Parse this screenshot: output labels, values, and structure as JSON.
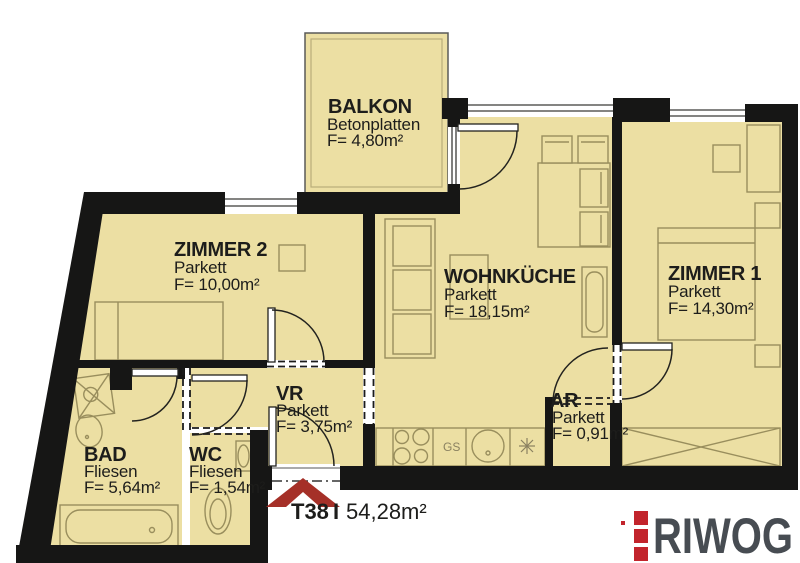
{
  "plan": {
    "unit": {
      "label": "T38",
      "separator": "I",
      "area": "54,28m²"
    },
    "rooms": [
      {
        "name": "BALKON",
        "floor": "Betonplatten",
        "area": "F= 4,80m²"
      },
      {
        "name": "ZIMMER 2",
        "floor": "Parkett",
        "area": "F= 10,00m²"
      },
      {
        "name": "WOHNKÜCHE",
        "floor": "Parkett",
        "area": "F= 18,15m²"
      },
      {
        "name": "ZIMMER 1",
        "floor": "Parkett",
        "area": "F= 14,30m²"
      },
      {
        "name": "BAD",
        "floor": "Fliesen",
        "area": "F= 5,64m²"
      },
      {
        "name": "WC",
        "floor": "Fliesen",
        "area": "F= 1,54m²"
      },
      {
        "name": "VR",
        "floor": "Parkett",
        "area": "F= 3,75m²"
      },
      {
        "name": "AR",
        "floor": "Parkett",
        "area": "F= 0,91m²"
      }
    ],
    "kitchen": {
      "gs_label": "GS"
    },
    "branding": {
      "logo_text": "RIWOG",
      "logo_color": "#474c52",
      "logo_accent": "#c2242c"
    },
    "colors": {
      "floor_fill": "#ecdfa3",
      "wall": "#161615",
      "entrance_arrow": "#a53028"
    }
  }
}
